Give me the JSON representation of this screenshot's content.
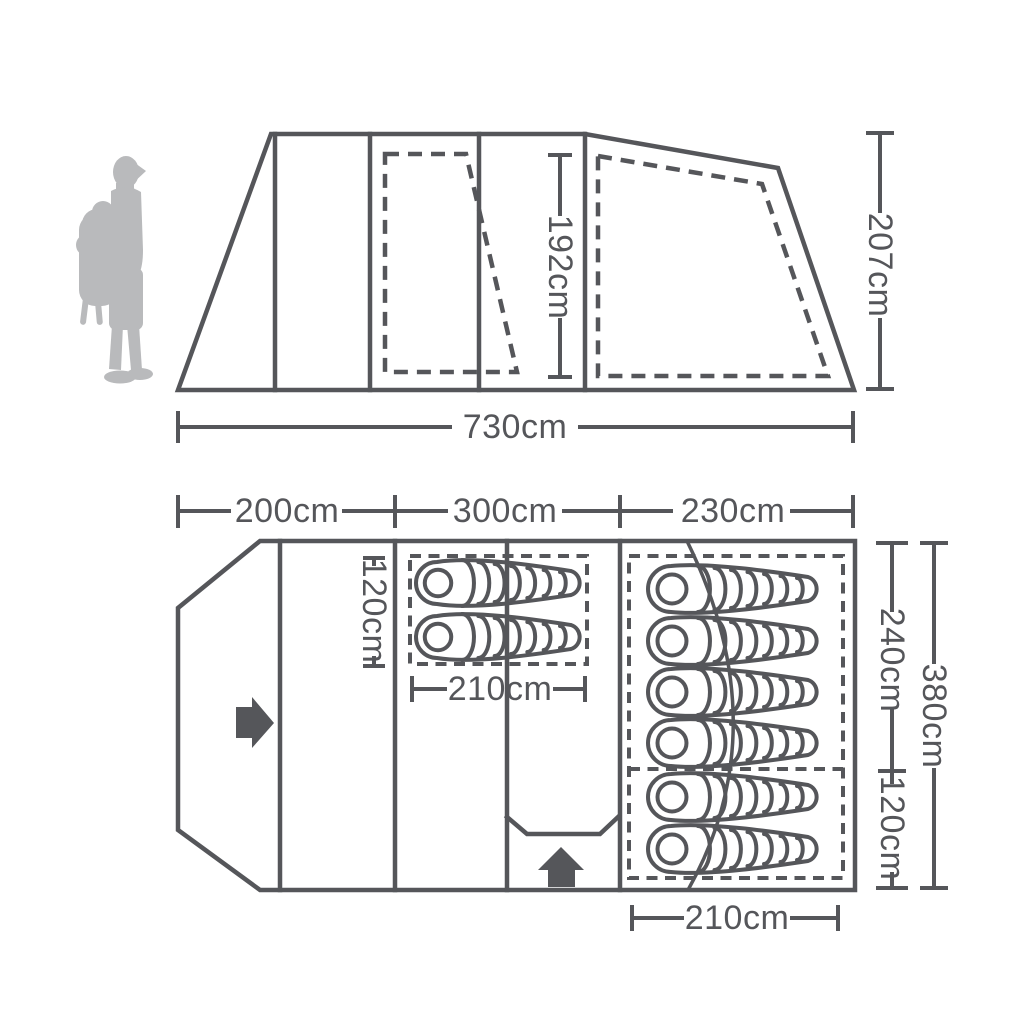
{
  "diagram_type": "tent-dimensions-diagram",
  "colors": {
    "line": "#55565a",
    "silhouette": "#b9babc",
    "arrow": "#55565a",
    "background": "#ffffff"
  },
  "side_view": {
    "length": "730cm",
    "height": "207cm",
    "standing_height": "192cm"
  },
  "floor_plan": {
    "sections": [
      {
        "label": "200cm"
      },
      {
        "label": "300cm"
      },
      {
        "label": "230cm"
      }
    ],
    "front_bedroom": {
      "sleeping_bags": 2,
      "width": "210cm",
      "depth": "120cm"
    },
    "rear_bedroom": {
      "sleeping_bags_main": 4,
      "sleeping_bags_small": 2,
      "width": "210cm",
      "depth_main": "240cm",
      "depth_small": "120cm",
      "depth_total": "380cm"
    }
  }
}
